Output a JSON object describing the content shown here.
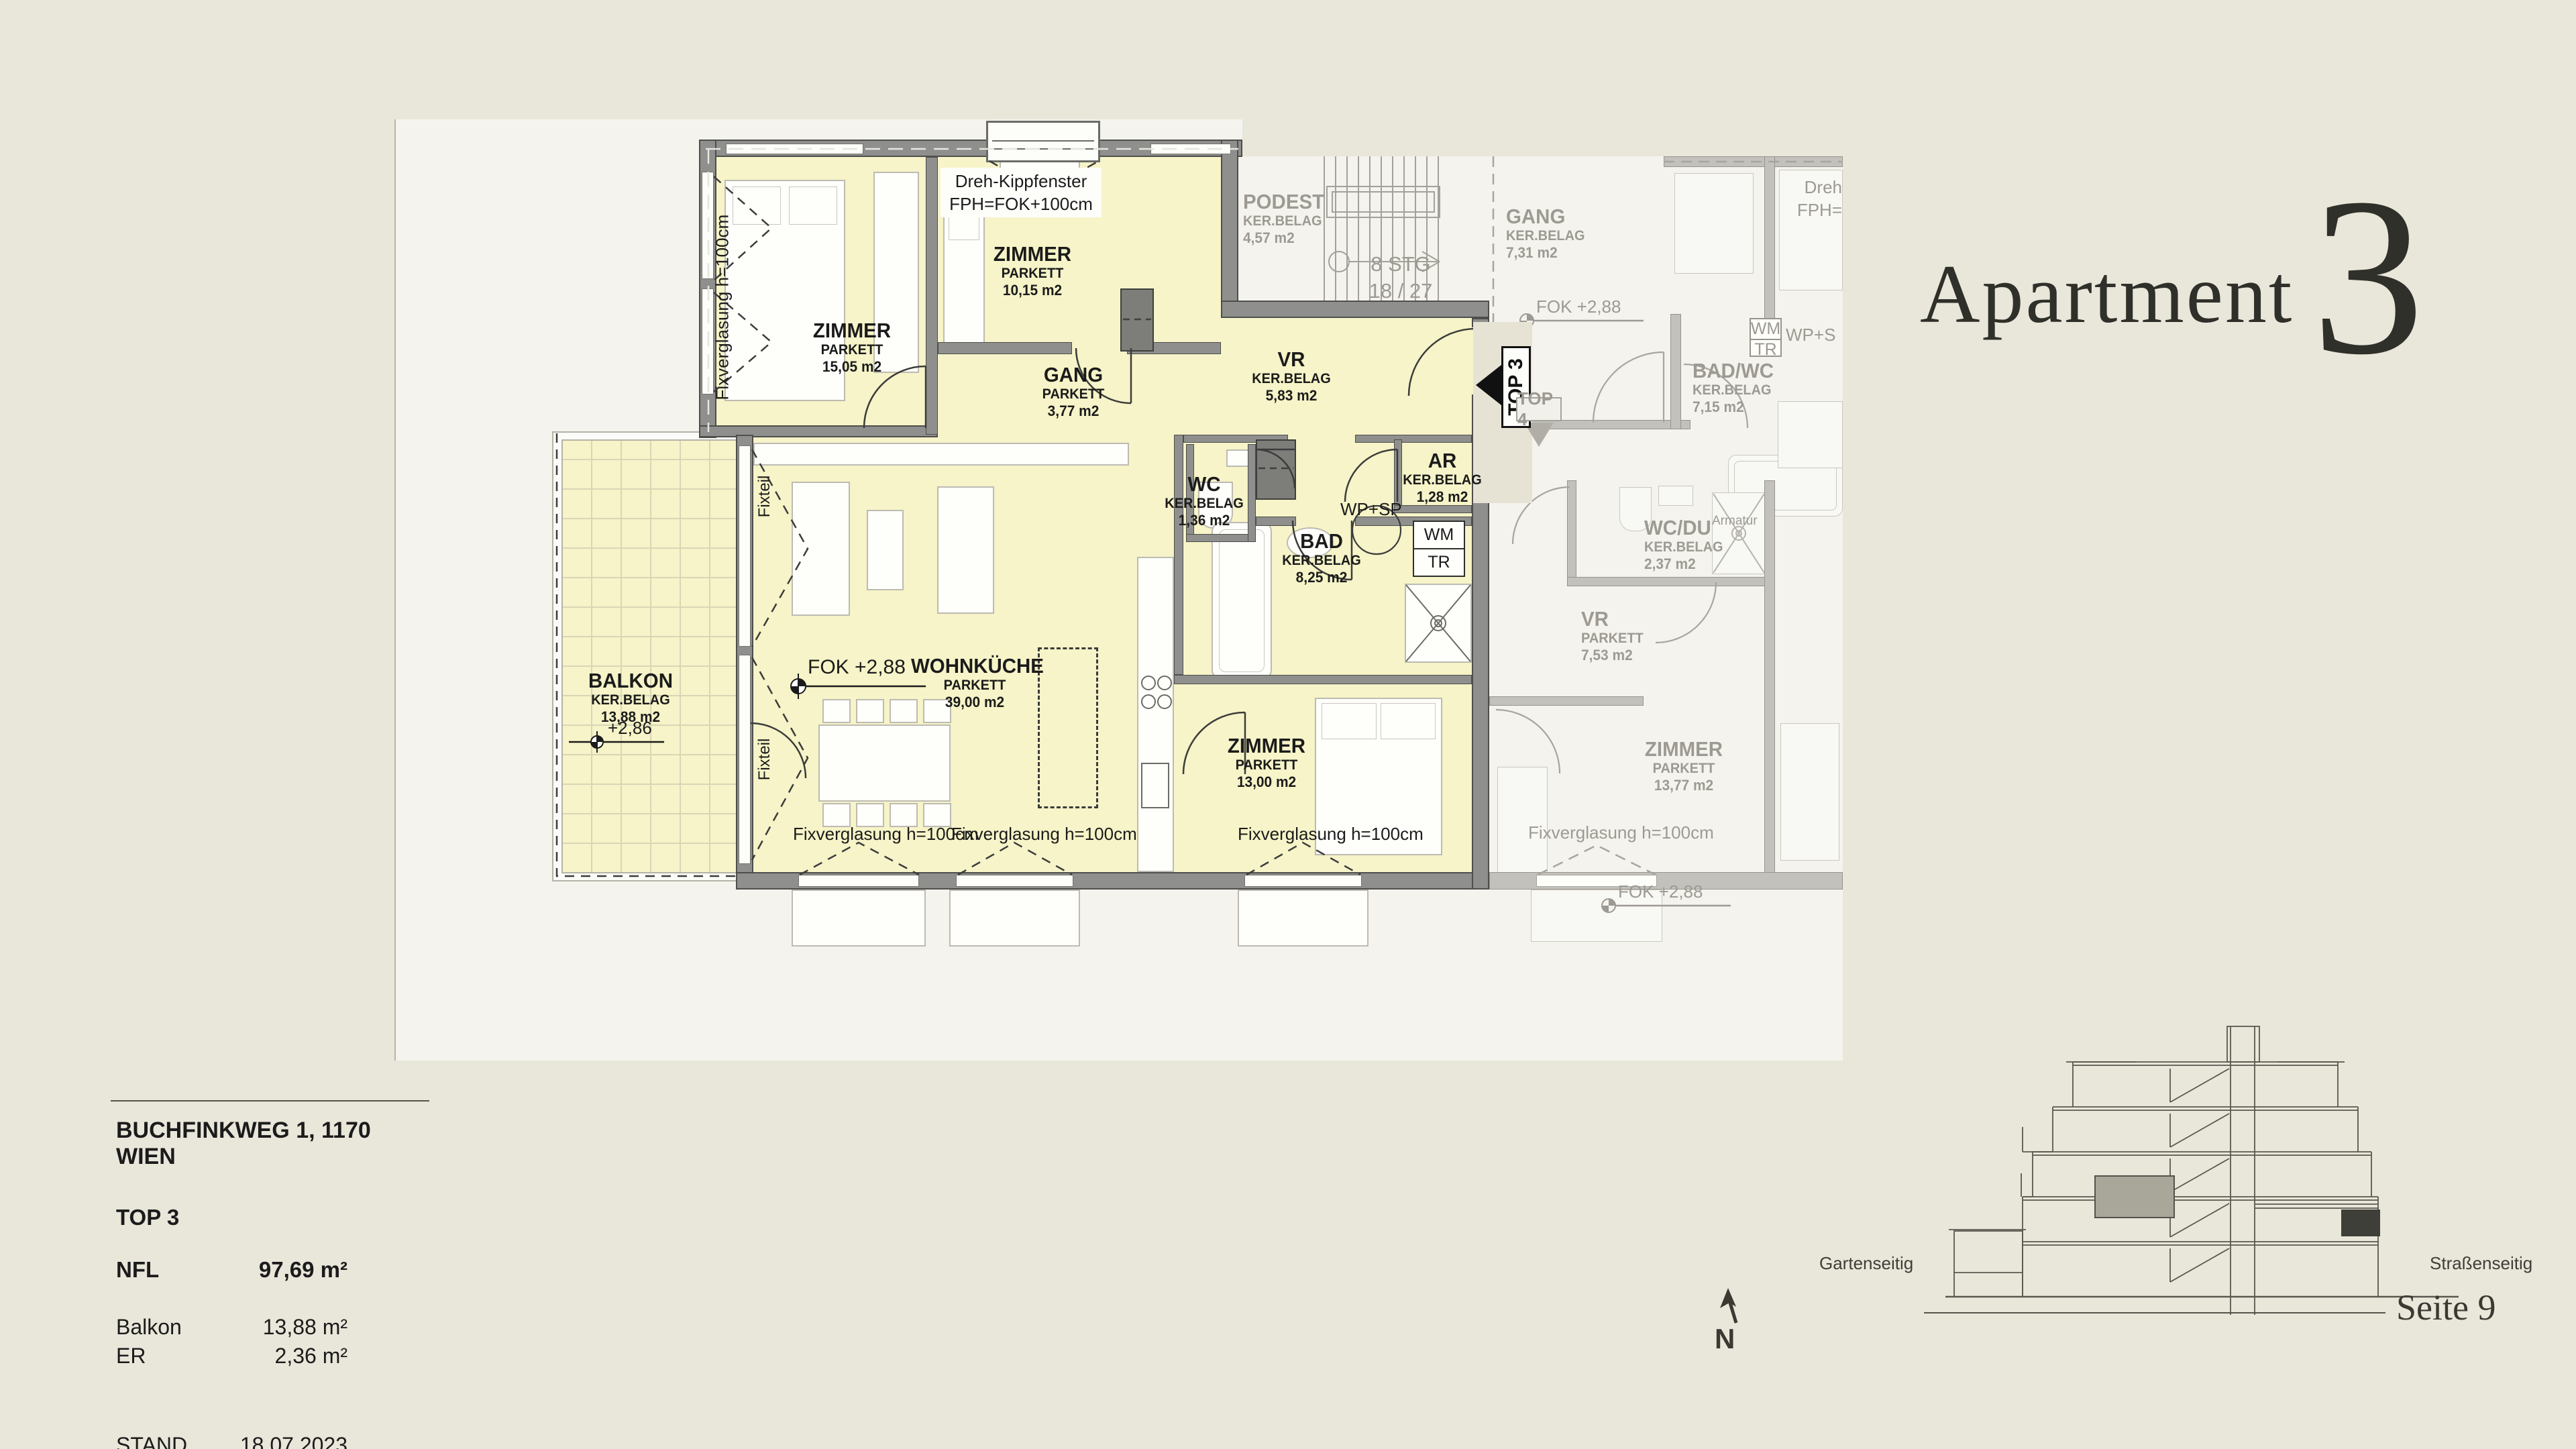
{
  "title": {
    "word": "Apartment",
    "number": "3"
  },
  "plan": {
    "rooms": {
      "z15": {
        "name": "ZIMMER",
        "floor": "PARKETT",
        "area": "15,05 m2"
      },
      "z10": {
        "name": "ZIMMER",
        "floor": "PARKETT",
        "area": "10,15 m2"
      },
      "gang": {
        "name": "GANG",
        "floor": "PARKETT",
        "area": "3,77 m2"
      },
      "vr": {
        "name": "VR",
        "floor": "KER.BELAG",
        "area": "5,83 m2"
      },
      "wc": {
        "name": "WC",
        "floor": "KER.BELAG",
        "area": "1,36 m2"
      },
      "bad": {
        "name": "BAD",
        "floor": "KER.BELAG",
        "area": "8,25 m2"
      },
      "ar": {
        "name": "AR",
        "floor": "KER.BELAG",
        "area": "1,28 m2"
      },
      "wohnkueche": {
        "name": "WOHNKÜCHE",
        "floor": "PARKETT",
        "area": "39,00 m2"
      },
      "z13": {
        "name": "ZIMMER",
        "floor": "PARKETT",
        "area": "13,00 m2"
      },
      "balkon": {
        "name": "BALKON",
        "floor": "KER.BELAG",
        "area": "13,88 m2"
      }
    },
    "neighbor": {
      "podest": {
        "name": "PODEST",
        "floor": "KER.BELAG",
        "area": "4,57 m2"
      },
      "stairs1": "8 STG",
      "stairs2": "18 / 27",
      "gang": {
        "name": "GANG",
        "floor": "KER.BELAG",
        "area": "7,31 m2"
      },
      "badwc": {
        "name": "BAD/WC",
        "floor": "KER.BELAG",
        "area": "7,15 m2"
      },
      "wcdu": {
        "name": "WC/DU",
        "floor": "KER.BELAG",
        "area": "2,37 m2"
      },
      "vr": {
        "name": "VR",
        "floor": "PARKETT",
        "area": "7,53 m2"
      },
      "zimmer": {
        "name": "ZIMMER",
        "floor": "PARKETT",
        "area": "13,77 m2"
      },
      "wm": "WM",
      "tr": "TR",
      "wps": "WP+S",
      "dreh": "Dreh",
      "fph": "FPH=",
      "armatur": "Armatur",
      "fok": "FOK +2,88",
      "fix": "Fixverglasung h=100cm"
    },
    "ann": {
      "dreh1": "Dreh-Kippfenster",
      "dreh2": "FPH=FOK+100cm",
      "fix": "Fixverglasung h=100cm",
      "fixteil": "Fixteil",
      "fok": "FOK +2,88",
      "lvl": "+2,86",
      "wm": "WM",
      "tr": "TR",
      "wpsp": "WP+SP",
      "top3": "TOP 3",
      "top4": "TOP 4"
    }
  },
  "info": {
    "address": "BUCHFINKWEG 1, 1170 WIEN",
    "top": "TOP 3",
    "nfl_label": "NFL",
    "nfl": "97,69 m²",
    "balkon_label": "Balkon",
    "balkon": "13,88 m²",
    "er_label": "ER",
    "er": "2,36 m²",
    "stand_label": "STAND",
    "stand": "18.07.2023"
  },
  "section": {
    "left": "Gartenseitig",
    "right": "Straßenseitig",
    "page": "Seite 9"
  },
  "north": "N",
  "colors": {
    "page": "#e9e6da",
    "plan_bg": "#f4f3ed",
    "room_fill": "#f6f4c8",
    "wall": "#8f8f8d",
    "neighbor_wall": "#c3c1bb",
    "text": "#1b1b1b",
    "neighbor_text": "#9c9a92",
    "section_highlight": "#a8a79a"
  }
}
